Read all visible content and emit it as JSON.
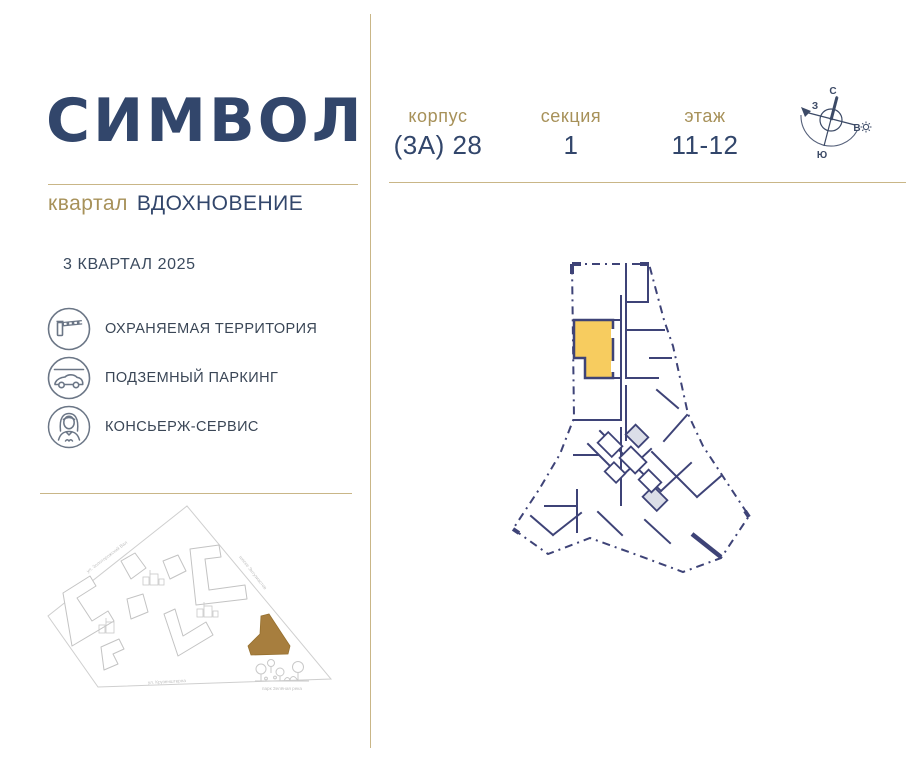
{
  "brand": {
    "logo": "СИМВОЛ",
    "district_type": "квартал",
    "district_name": "ВДОХНОВЕНИЕ"
  },
  "completion_date": "3 КВАРТАЛ 2025",
  "amenities": [
    {
      "icon": "barrier-icon",
      "label": "ОХРАНЯЕМАЯ ТЕРРИТОРИЯ"
    },
    {
      "icon": "car-icon",
      "label": "ПОДЗЕМНЫЙ ПАРКИНГ"
    },
    {
      "icon": "concierge-icon",
      "label": "КОНСЬЕРЖ-СЕРВИС"
    }
  ],
  "unit_info": {
    "fields": [
      {
        "label": "корпус",
        "value": "(3А) 28"
      },
      {
        "label": "секция",
        "value": "1"
      },
      {
        "label": "этаж",
        "value": "11-12"
      }
    ]
  },
  "compass": {
    "north": "С",
    "east": "В",
    "south": "Ю",
    "west": "З"
  },
  "site_map": {
    "street_top_left": "ул. Золоторожский Вал",
    "street_right": "шоссе Энтузиастов",
    "street_bottom": "ул. Крузенштерна",
    "park_label": "парк Зелёная река"
  },
  "colors": {
    "navy_text": "#32466B",
    "gold_label": "#A79159",
    "gold_divider": "#C9B687",
    "plan_wall": "#3E4377",
    "unit_highlight": "#F7CC5F",
    "map_building_highlight": "#A77E3E",
    "icon_stroke": "#6B7686"
  }
}
